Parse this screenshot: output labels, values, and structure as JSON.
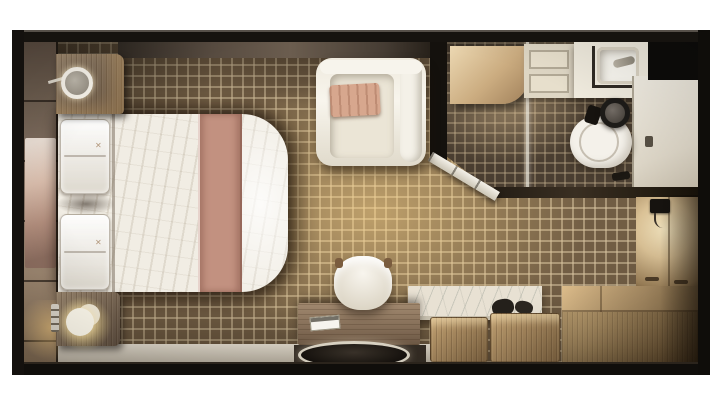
{
  "scene": {
    "title": "Cruise stateroom floor plan - top-down 3D render",
    "background": "#ffffff"
  },
  "colors": {
    "wall": "#14110e",
    "floor_tile": "#715d44",
    "floor_grout": "#d6c29e",
    "shower_tile": "#4a3e31",
    "bed_duvet": "#f1ede4",
    "bed_runner": "#c29180",
    "pillow_white": "#eeebe3",
    "nightstand_wood": "#77675a",
    "armchair": "#f3f0e7",
    "armchair_pillow": "#d7a78e",
    "desk_wood": "#8d7560",
    "counter_dark": "#342c24",
    "marble_top": "#e8e1d3",
    "box_wood": "#ab8a5e",
    "bench_wood": "#b8945f",
    "closet_wall": "#e6d4ae",
    "vanity_white": "#efeadd",
    "toilet_white": "#f4f1ea",
    "toilet_lid": "#1d1b18",
    "entry_floor": "#efebe1",
    "glass": "#e9e6dd",
    "ledge": "#cdc5b8",
    "artwork": "#cdb1a0",
    "lamp_glow": "#ffe9b8"
  },
  "bed": {
    "emblem": "✕"
  },
  "furniture": {
    "bed": "Double bed with accent runner",
    "pillows": "Pillows",
    "nightstand_top": "Nightstand with ring lamp",
    "nightstand_bottom": "Nightstand with cylinder lamp",
    "armchair": "Armchair with accent pillow",
    "desk": "Desk",
    "desk_chair": "Desk chair",
    "round_table": "Round table",
    "marble_console": "Marble-top console",
    "storage_box_a": "Storage box stool",
    "storage_box_b": "Storage box stool",
    "bench": "Wooden bench seat",
    "closet": "Wardrobe wall",
    "shower": "Shower with glass door",
    "vanity": "Vanity with sink",
    "toilet": "Toilet",
    "entry": "Entry area",
    "artwork": "Abstract artwork panel",
    "switch": "Switch panel",
    "phone": "Wall-mounted phone"
  }
}
